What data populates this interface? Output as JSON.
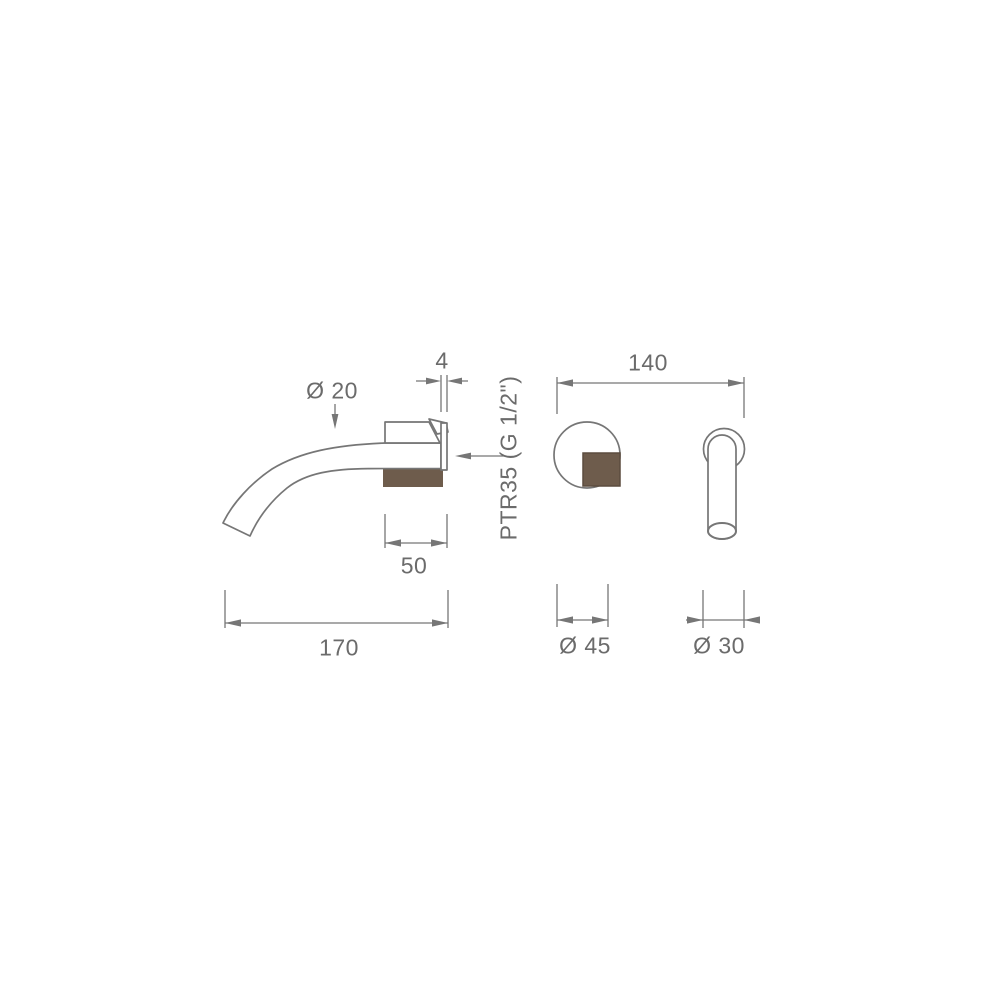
{
  "drawing": {
    "type": "technical dimension drawing",
    "subject": "wall-mounted curved basin spout with separate wall valve, three orthographic views",
    "units_shown": "mm"
  },
  "colors": {
    "background": "#ffffff",
    "line": "#767676",
    "text": "#6b6b6b",
    "wall_section": "#6e5c4c"
  },
  "labels": {
    "plate_thickness": "4",
    "spout_diameter": "Ø 20",
    "valve_spacing": "140",
    "thread_spec": "PTR35 (G 1/2\")",
    "mount_depth": "50",
    "spout_reach": "170",
    "valve_diameter": "Ø 45",
    "flange_diameter": "Ø 30"
  }
}
